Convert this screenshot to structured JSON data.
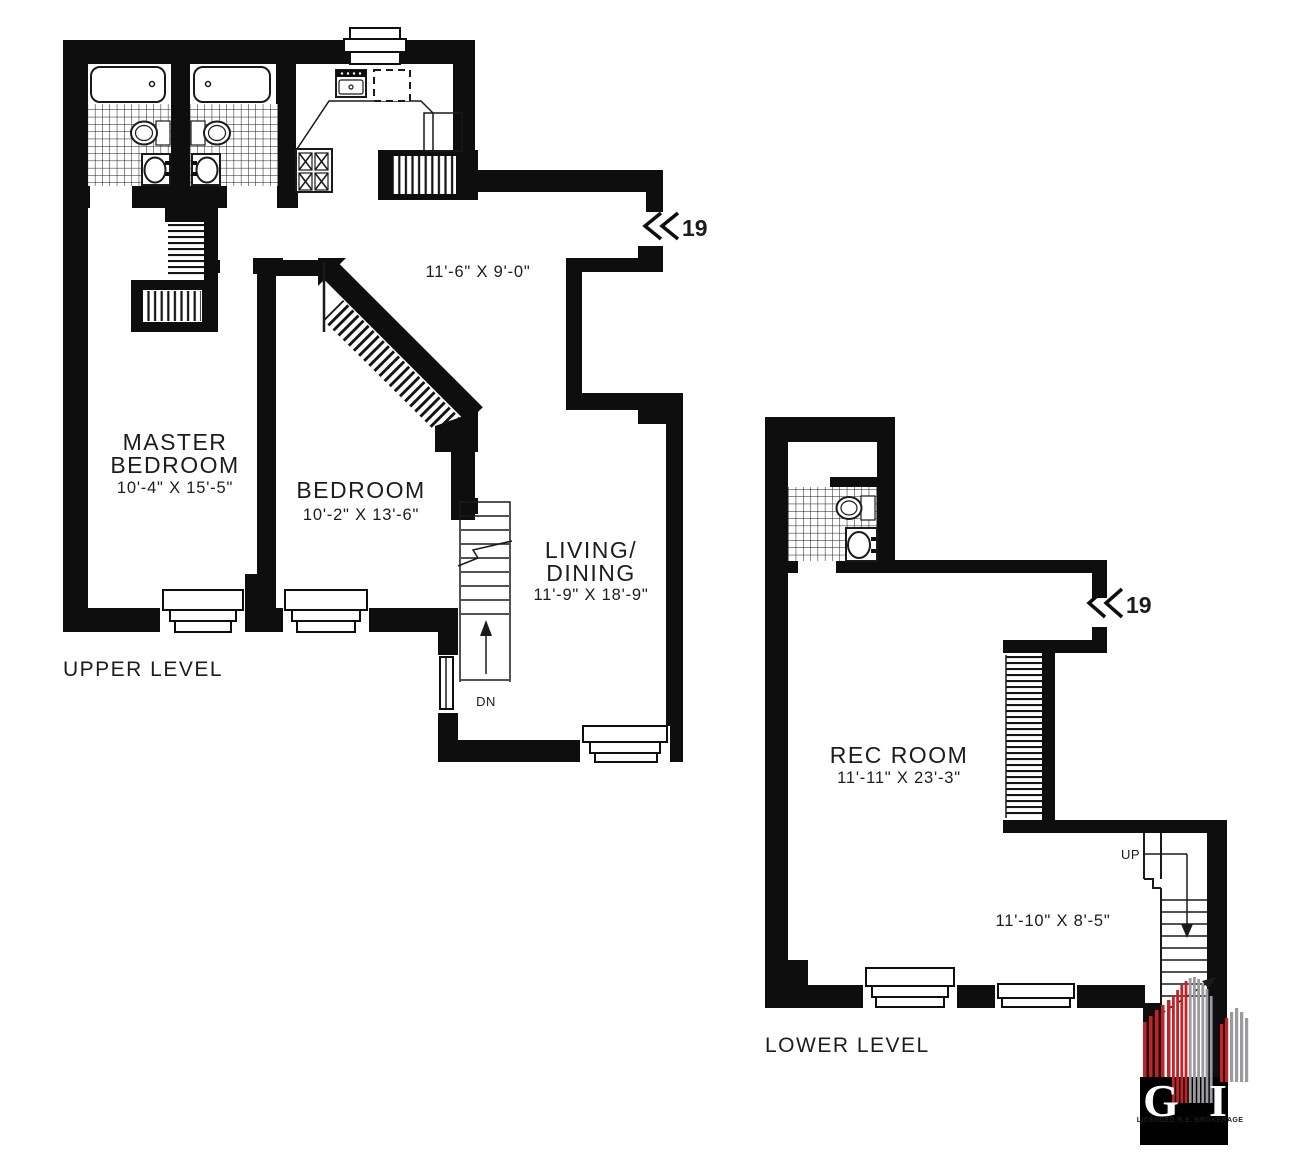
{
  "colors": {
    "ink": "#0e0e0e",
    "logo_red": "#c52127",
    "logo_gray": "#9b9b9d"
  },
  "upper_level": {
    "label": "UPPER LEVEL",
    "unit_marker": "19",
    "rooms": {
      "master_bedroom": {
        "name_line1": "MASTER",
        "name_line2": "BEDROOM",
        "dimensions": "10'-4\" X 15'-5\""
      },
      "bedroom": {
        "name": "BEDROOM",
        "dimensions": "10'-2\" X 13'-6\""
      },
      "living_dining": {
        "name_line1": "LIVING/",
        "name_line2": "DINING",
        "dimensions": "11'-9\" X 18'-9\""
      },
      "kitchen": {
        "dimensions": "11'-6\" X 9'-0\""
      }
    },
    "stairs": {
      "down_label": "DN"
    }
  },
  "lower_level": {
    "label": "LOWER LEVEL",
    "unit_marker": "19",
    "rooms": {
      "rec_room": {
        "name": "REC ROOM",
        "dimensions": "11'-11\" X 23'-3\""
      },
      "utility_area": {
        "dimensions": "11'-10\" X 8'-5\""
      }
    },
    "stairs": {
      "up_label": "UP"
    }
  },
  "logo": {
    "letter_left": "G",
    "letter_right": "I",
    "caption": "LICENSED R.E. BROKERAGE"
  }
}
